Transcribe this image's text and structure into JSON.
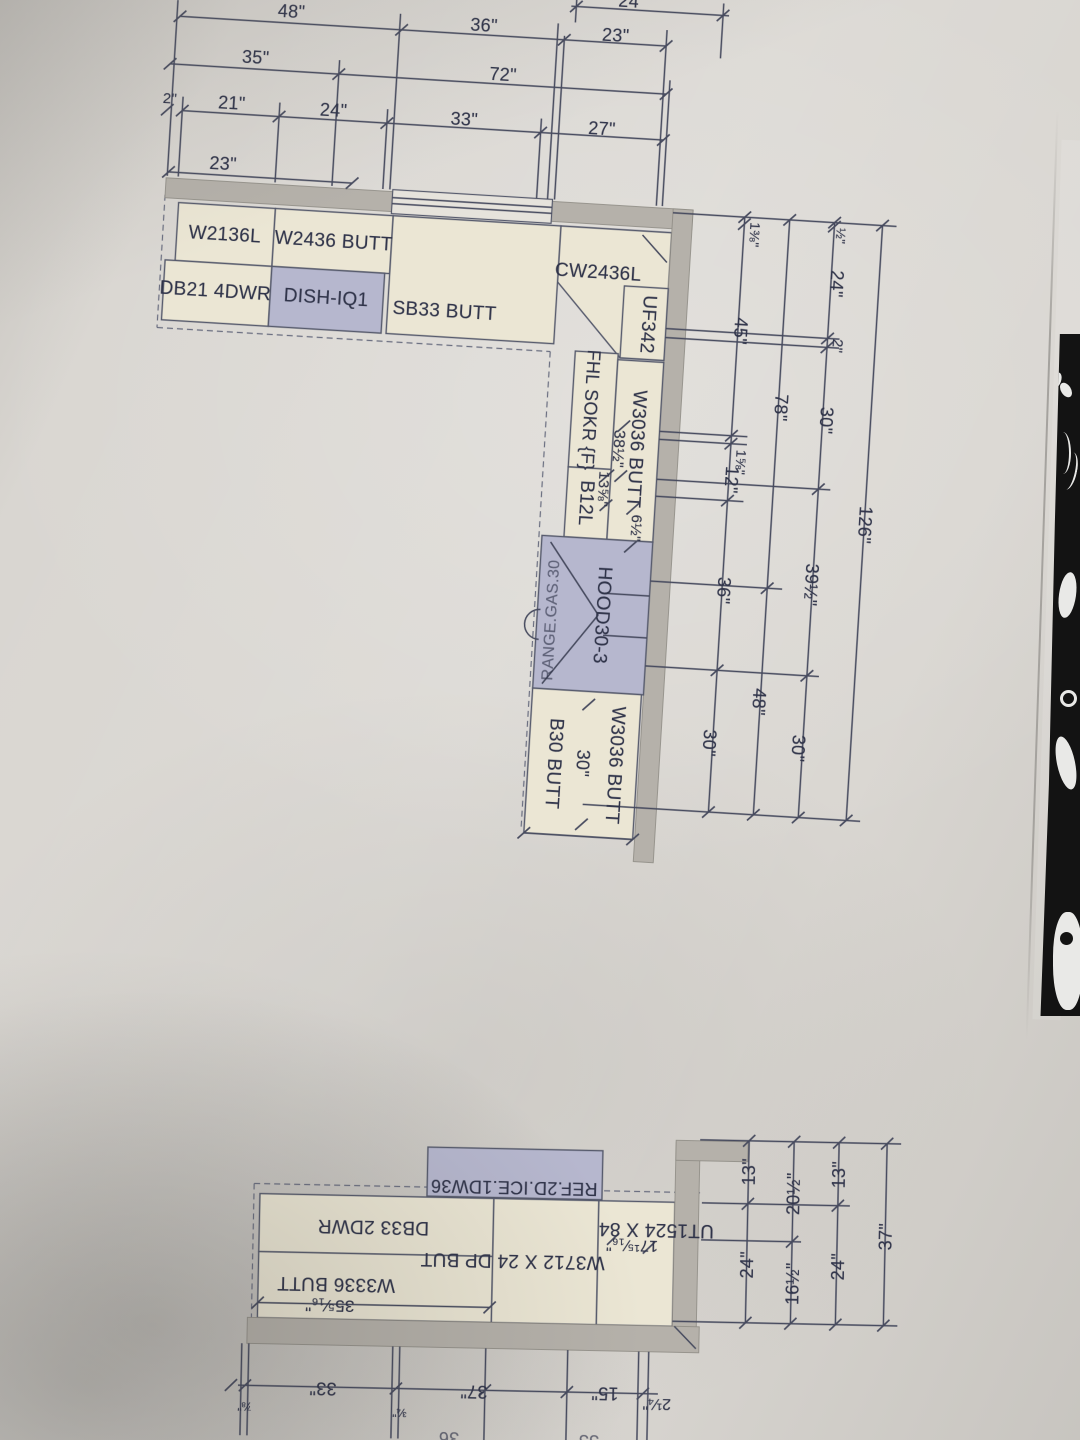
{
  "colors": {
    "paper": "#d9d6d1",
    "ink_line": "#464a5e",
    "ink_text": "#30344a",
    "cabinet_fill": "#ebe6d4",
    "appliance_fill": "#b6b7ce",
    "wall_fill": "#b5b1aa",
    "photo_background": "#131313"
  },
  "top_plan": {
    "cabinet_labels": [
      {
        "text": "W2136L",
        "x": 228,
        "y": 232
      },
      {
        "text": "W2436 BUTT",
        "x": 337,
        "y": 232
      },
      {
        "text": "DB21 4DWR",
        "x": 222,
        "y": 289
      },
      {
        "text": "DISH-IQ1",
        "x": 333,
        "y": 289
      },
      {
        "text": "SB33 BUTT",
        "x": 452,
        "y": 295
      },
      {
        "text": "CW2436L",
        "x": 603,
        "y": 247
      },
      {
        "text": "UF342",
        "x": 655,
        "y": 295,
        "rot": 90
      },
      {
        "text": "FHL SOKR {F}",
        "x": 603,
        "y": 384,
        "rot": 90,
        "fs": 18
      },
      {
        "text": "B12L",
        "x": 604,
        "y": 477,
        "rot": 90
      },
      {
        "text": "W3036 BUTT",
        "x": 651,
        "y": 420,
        "rot": 90
      },
      {
        "text": "HOOD30-3",
        "x": 627,
        "y": 588,
        "rot": 90
      },
      {
        "text": "RANGE.GAS.30",
        "x": 578,
        "y": 596,
        "rot": -90,
        "fs": 16,
        "cls": "faded"
      },
      {
        "text": "W3036 BUTT",
        "x": 649,
        "y": 737,
        "rot": 90
      },
      {
        "text": "B30 BUTT",
        "x": 588,
        "y": 739,
        "rot": 90
      }
    ],
    "dimension_labels": [
      {
        "text": "24",
        "x": 617,
        "y": -26
      },
      {
        "text": "48\"",
        "x": 281,
        "y": 5
      },
      {
        "text": "36\"",
        "x": 474,
        "y": 7
      },
      {
        "text": "23\"",
        "x": 606,
        "y": 9
      },
      {
        "text": "35\"",
        "x": 248,
        "y": 53
      },
      {
        "text": "72\"",
        "x": 496,
        "y": 55
      },
      {
        "text": "2\"",
        "x": 165,
        "y": 99,
        "fs": 15
      },
      {
        "text": "21\"",
        "x": 227,
        "y": 100
      },
      {
        "text": "24\"",
        "x": 329,
        "y": 101
      },
      {
        "text": "33\"",
        "x": 460,
        "y": 102
      },
      {
        "text": "27\"",
        "x": 598,
        "y": 103
      },
      {
        "text": "23\"",
        "x": 222,
        "y": 161
      },
      {
        "text": "38½\"",
        "x": 633,
        "y": 421,
        "rot": 90,
        "fs": 16
      },
      {
        "text": "13⅝\"",
        "x": 621,
        "y": 462,
        "rot": 90,
        "fs": 15
      },
      {
        "text": "6½\"",
        "x": 656,
        "y": 499,
        "rot": 90,
        "fs": 15
      },
      {
        "text": "30\"",
        "x": 617,
        "y": 737,
        "rot": 90
      },
      {
        "text": "1⅜\"",
        "x": 757,
        "y": 199,
        "rot": 90,
        "fs": 14
      },
      {
        "text": "45\"",
        "x": 748,
        "y": 296,
        "rot": 90
      },
      {
        "text": "1⅝\"",
        "x": 757,
        "y": 427,
        "rot": 90,
        "fs": 14
      },
      {
        "text": "12\"",
        "x": 748,
        "y": 445,
        "rot": 90
      },
      {
        "text": "36\"",
        "x": 747,
        "y": 556,
        "rot": 90
      },
      {
        "text": "30\"",
        "x": 742,
        "y": 709,
        "rot": 90
      },
      {
        "text": "78\"",
        "x": 793,
        "y": 370,
        "rot": 90
      },
      {
        "text": "48\"",
        "x": 789,
        "y": 665,
        "rot": 90
      },
      {
        "text": "½\"",
        "x": 843,
        "y": 195,
        "rot": 90,
        "fs": 13
      },
      {
        "text": "24\"",
        "x": 841,
        "y": 243,
        "rot": 90
      },
      {
        "text": "2\"",
        "x": 846,
        "y": 305,
        "rot": 90,
        "fs": 15
      },
      {
        "text": "30\"",
        "x": 839,
        "y": 380,
        "rot": 90
      },
      {
        "text": "39½\"",
        "x": 834,
        "y": 545,
        "rot": 90
      },
      {
        "text": "30\"",
        "x": 831,
        "y": 709,
        "rot": 90
      },
      {
        "text": "126\"",
        "x": 884,
        "y": 482,
        "rot": 90
      }
    ]
  },
  "bottom_plan": {
    "cabinet_labels": [
      {
        "text": "REF.2D.ICE.1DW36",
        "x": 512,
        "y": 126,
        "rot": 180,
        "fs": 18
      },
      {
        "text": "DB33 2DWR",
        "x": 372,
        "y": 168,
        "rot": 180
      },
      {
        "text": "W3336 BUTT",
        "x": 336,
        "y": 226,
        "rot": 180
      },
      {
        "text": "W3712 X 24 DP BUT",
        "x": 512,
        "y": 199,
        "rot": 180
      },
      {
        "text": "UT1524 X 84",
        "x": 655,
        "y": 165,
        "rot": 180
      }
    ],
    "dimension_labels": [
      {
        "text": "35⁵⁄₁₆\"",
        "x": 330,
        "y": 248,
        "rot": 180,
        "fs": 17
      },
      {
        "text": "17¹⁵⁄₁₆\"",
        "x": 631,
        "y": 181,
        "rot": 180,
        "fs": 16
      },
      {
        "text": "13\"",
        "x": 747,
        "y": 106,
        "rot": -90
      },
      {
        "text": "24\"",
        "x": 747,
        "y": 199,
        "rot": -90
      },
      {
        "text": "20½\"",
        "x": 792,
        "y": 127,
        "rot": -90
      },
      {
        "text": "16½\"",
        "x": 793,
        "y": 217,
        "rot": -90
      },
      {
        "text": "13\"",
        "x": 837,
        "y": 107,
        "rot": -90
      },
      {
        "text": "24\"",
        "x": 838,
        "y": 199,
        "rot": -90
      },
      {
        "text": "37\"",
        "x": 885,
        "y": 168,
        "rot": -90
      },
      {
        "text": "33\"",
        "x": 325,
        "y": 331,
        "rot": 180
      },
      {
        "text": "37\"",
        "x": 476,
        "y": 331,
        "rot": 180
      },
      {
        "text": "15\"",
        "x": 607,
        "y": 330,
        "rot": 180
      },
      {
        "text": "2¼\"",
        "x": 659,
        "y": 339,
        "rot": 180,
        "fs": 16
      },
      {
        "text": "⅞\"",
        "x": 247,
        "y": 351,
        "rot": 180,
        "fs": 12
      },
      {
        "text": "¾\"",
        "x": 402,
        "y": 354,
        "rot": 180,
        "fs": 12
      },
      {
        "text": "36",
        "x": 452,
        "y": 378,
        "rot": 180,
        "cls": "faded"
      },
      {
        "text": "33",
        "x": 592,
        "y": 378,
        "rot": 180,
        "cls": "faded"
      }
    ]
  }
}
